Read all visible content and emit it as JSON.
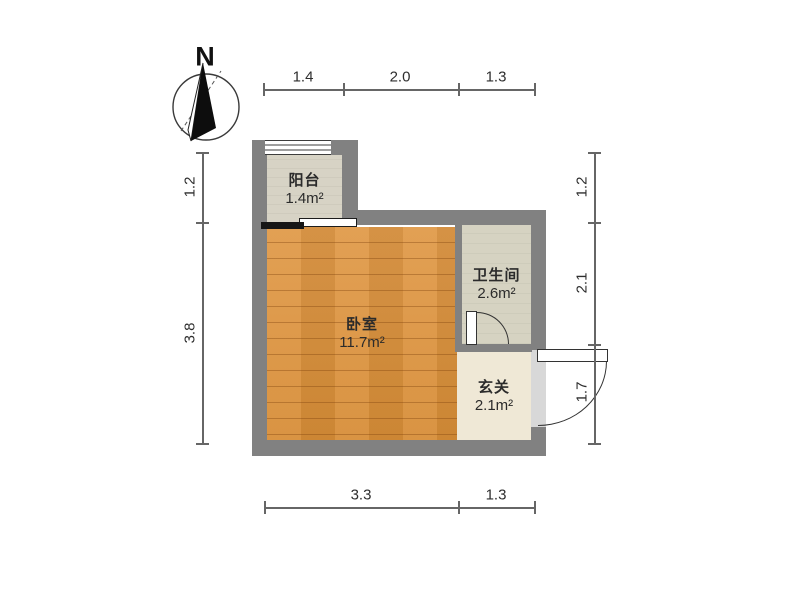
{
  "title": "apartment-floor-plan",
  "compass": {
    "north_label": "N"
  },
  "rooms": [
    {
      "id": "balcony",
      "name": "阳台",
      "area": "1.4m²"
    },
    {
      "id": "bedroom",
      "name": "卧室",
      "area": "11.7m²"
    },
    {
      "id": "bathroom",
      "name": "卫生间",
      "area": "2.6m²"
    },
    {
      "id": "hallway",
      "name": "玄关",
      "area": "2.1m²"
    }
  ],
  "dimensions": {
    "unit": "m",
    "top": [
      "1.4",
      "2.0",
      "1.3"
    ],
    "left": [
      "1.2",
      "3.8"
    ],
    "right": [
      "1.2",
      "2.1",
      "1.7"
    ],
    "bottom": [
      "3.3",
      "1.3"
    ]
  },
  "colors": {
    "wall": "#818181",
    "wood": "#dd9544",
    "balcony-tile": "#d7d3c5",
    "bath-tile": "#d6d3c2",
    "hall-tile": "#efe8d6",
    "door-opening": "#d8d8d8",
    "dim-line": "#666666",
    "text": "#2b2b2b"
  }
}
